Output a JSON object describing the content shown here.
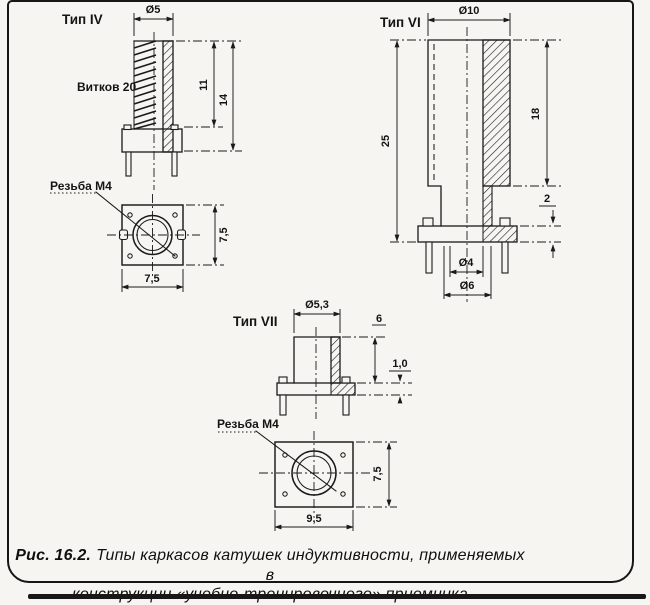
{
  "colors": {
    "ink": "#1a1a1a",
    "paper": "#f6f5f1"
  },
  "caption": {
    "prefix": "Рис. 16.2.",
    "line1": "Типы каркасов катушек индуктивности, применяемых в",
    "line2": "конструкции «учебно-тренировочного» приемника"
  },
  "type_iv": {
    "title": "Тип IV",
    "turns_label": "Витков 20",
    "thread_label": "Резьба М4",
    "dim_diameter": "Ø5",
    "dim_height_inner": "11",
    "dim_height_full": "14",
    "dim_base_height": "7,5",
    "dim_base_width": "7,5"
  },
  "type_vi": {
    "title": "Тип VI",
    "dim_diameter": "Ø10",
    "dim_height_body": "18",
    "dim_height_full": "25",
    "dim_flange_thickness": "2",
    "dim_stem_inner": "Ø4",
    "dim_stem_outer": "Ø6"
  },
  "type_vii": {
    "title": "Тип VII",
    "dim_diameter": "Ø5,3",
    "dim_height": "6",
    "dim_flange_thickness": "1,0",
    "thread_label": "Резьба М4",
    "dim_base_height": "7,5",
    "dim_base_width": "9,5"
  }
}
